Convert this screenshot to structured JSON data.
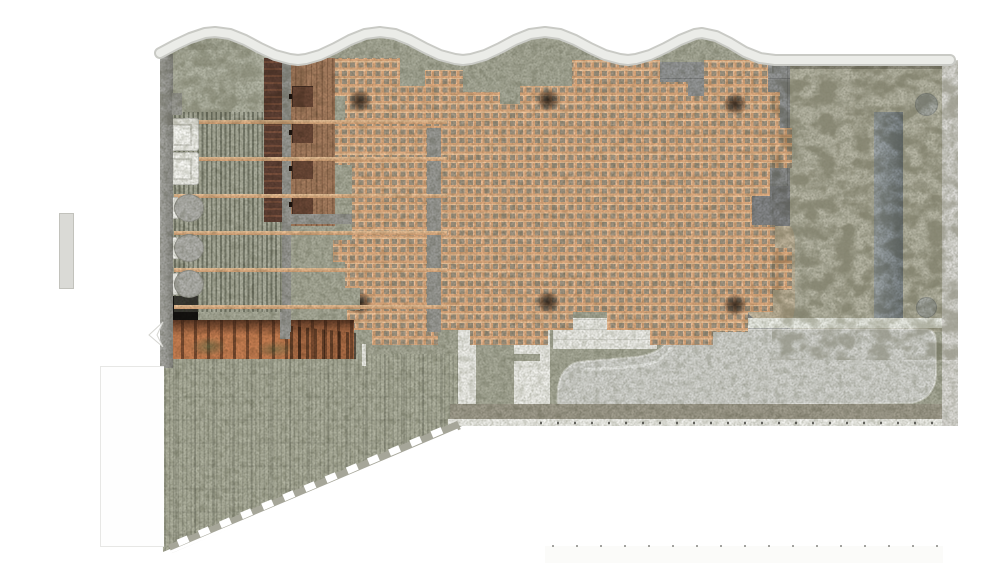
{
  "meta": {
    "description": "Top-down architectural floor plan rendering of a bathhouse-like interior: wavy roof wall along the top, central orange timber lattice canopy with six dark columns, terrazzo floors, left service block with slatted screen, lockers, wood deck, two sinks and three toilets, a stair flight, a sloped terrazzo ramp with dashed edge at lower left, concrete and coarse-aggregate terrazzo zones at right with a counter and two round columns, and a light grey free-form pool zone with white partitions at the bottom."
  },
  "palette": {
    "page_bg": "#ffffff",
    "terrazzo": "#a9ab9a",
    "terrazzo_light": "#b4b6a6",
    "terrazzo_coarse": "#b8b7a6",
    "slope": "#b1b3a1",
    "concrete": "#8f9192",
    "sand": "#c5b9a1",
    "wall_gray": "#9e9e99",
    "wall_gravel": "#a19d8e",
    "band_white": "#ebece8",
    "band_edge": "#c9cac5",
    "lattice_line": "#e2ad81",
    "lattice_cell": "#a39784",
    "wood_deck": "#a87e60",
    "locker_brown": "#5f4034",
    "stair_orange": "#c97f52",
    "stair_tread": "#4a2e1f",
    "pool": "#d5d6d2",
    "partition_white": "#f1f1ed",
    "counter": "#8c959a",
    "column_smudge": "#261c14"
  },
  "zones": {
    "roof_wall": "wavy-top-wall",
    "lattice_canopy": "orange-timber-lattice",
    "service_block": "slatted-screen-lockers-deck",
    "sanitary": "sinks-and-toilets",
    "stairs": "orange-stair-flight",
    "ramp": "sloped-terrazzo-ramp",
    "pool_zone": "free-form-pool-with-partitions",
    "right_zone": "coarse-terrazzo-with-counter"
  },
  "counts": {
    "roof_wave_crests": 4,
    "lattice_columns": 6,
    "overhead_beams": 6,
    "sinks": 2,
    "toilets": 3,
    "deck_stools": 4,
    "round_columns": 2,
    "edge_dashes": 12
  },
  "wave": {
    "crests_x": [
      215,
      380,
      545,
      700
    ],
    "crest_y": 32,
    "valley_y": 60
  }
}
